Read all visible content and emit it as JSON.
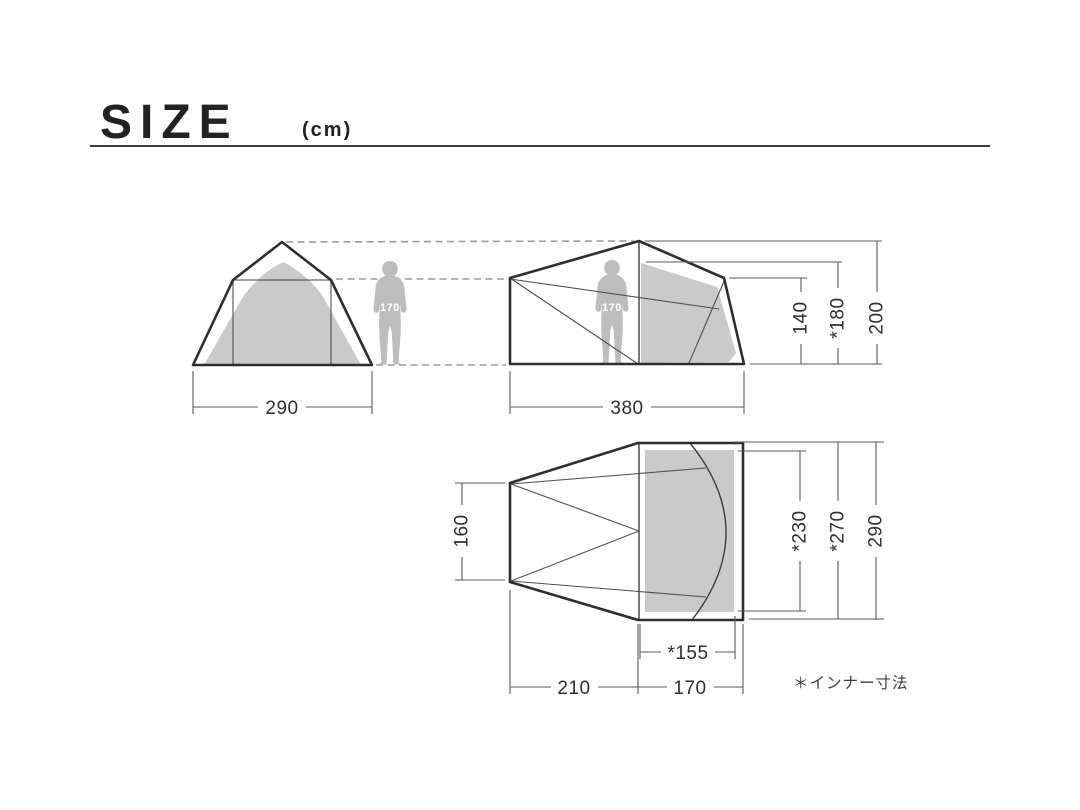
{
  "title": {
    "text": "SIZE",
    "unit": "(cm)"
  },
  "footnote": "＊インナー寸法",
  "colors": {
    "outline": "#2e2e2e",
    "thin_line": "#4f4f4f",
    "dashed_line": "#9a9a9a",
    "tent_fill": "#cacaca",
    "human_fill": "#bdbdbd",
    "dim_text": "#2e2e2e"
  },
  "front_view": {
    "width": "290",
    "human_height": "170"
  },
  "side_view": {
    "width": "380",
    "eave_height": "140",
    "inner_height": "*180",
    "total_height": "200",
    "human_height": "170"
  },
  "plan_view": {
    "left_depth": "160",
    "inner_depth": "*230",
    "outer_inner_depth": "*270",
    "total_depth": "290",
    "inner_door_width": "*155",
    "vestibule_length": "210",
    "inner_length": "170"
  }
}
